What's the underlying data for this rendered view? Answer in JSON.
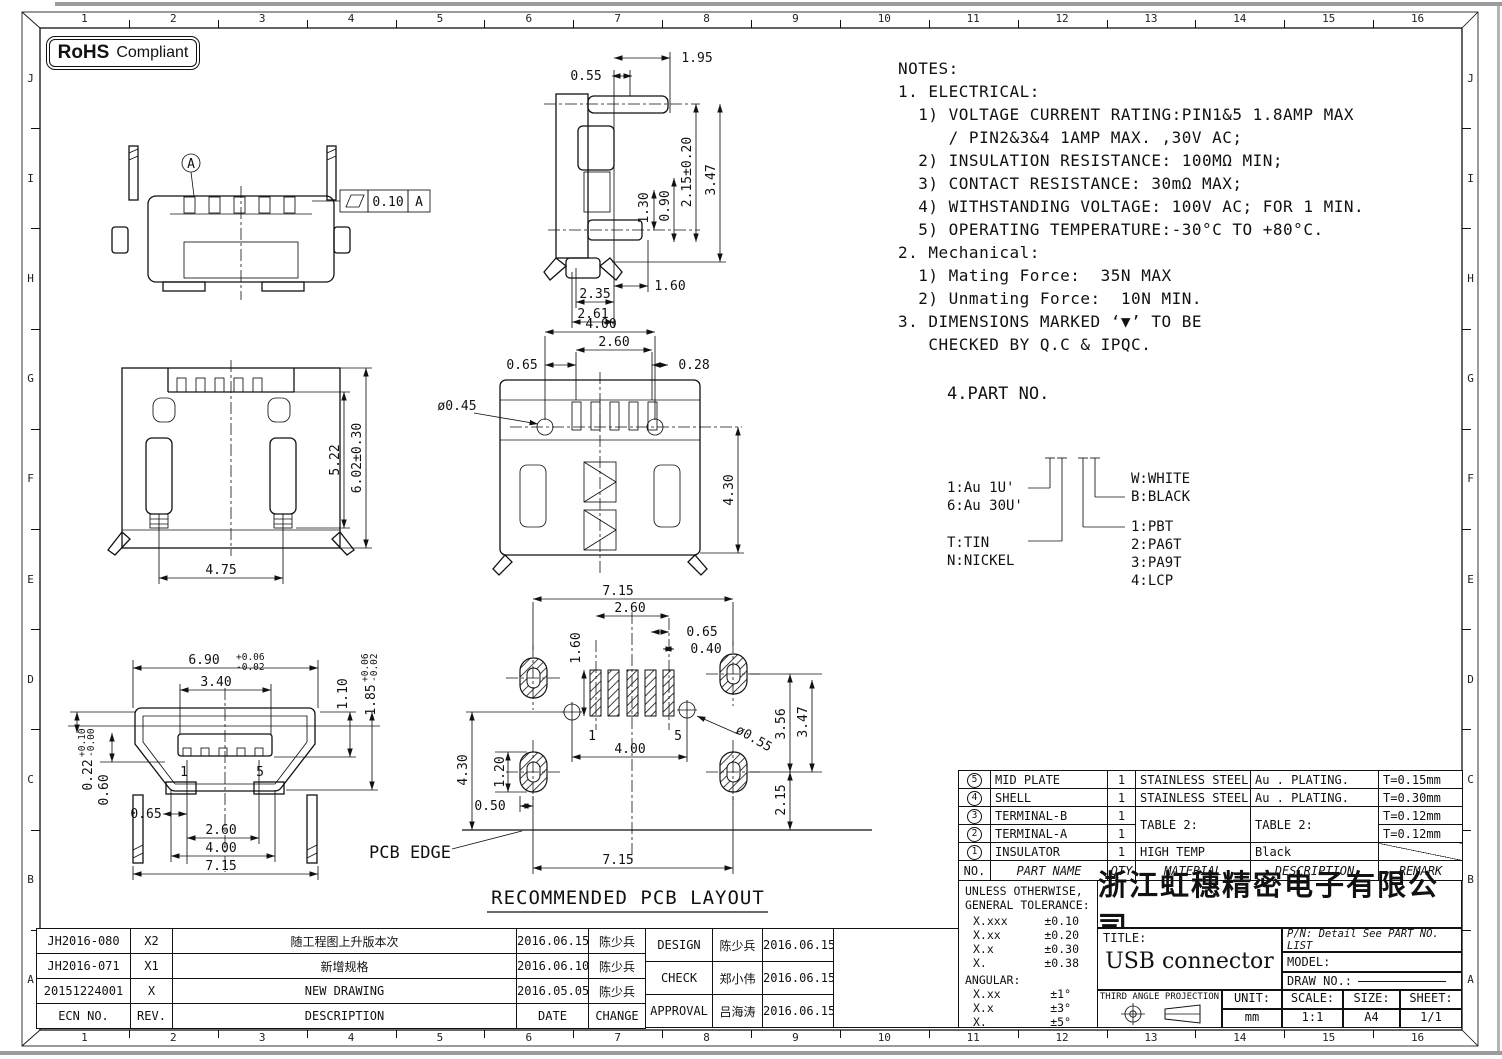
{
  "sheet": {
    "rohs_bold": "RoHS",
    "rohs_rest": "Compliant",
    "border_cols": [
      "1",
      "2",
      "3",
      "4",
      "5",
      "6",
      "7",
      "8",
      "9",
      "10",
      "11",
      "12",
      "13",
      "14",
      "15",
      "16"
    ],
    "border_rows": [
      "J",
      "I",
      "H",
      "G",
      "F",
      "E",
      "D",
      "C",
      "B",
      "A"
    ]
  },
  "notes": {
    "lines": [
      "NOTES:",
      "1. ELECTRICAL:",
      "  1) VOLTAGE CURRENT RATING:PIN1&5 1.8AMP MAX",
      "     / PIN2&3&4 1AMP MAX. ,30V AC;",
      "  2) INSULATION RESISTANCE: 100MΩ MIN;",
      "  3) CONTACT RESISTANCE: 30mΩ MAX;",
      "  4) WITHSTANDING VOLTAGE: 100V AC; FOR 1 MIN.",
      "  5) OPERATING TEMPERATURE:-30°C TO +80°C.",
      "2. Mechanical:",
      "  1) Mating Force:  35N MAX",
      "  2) Unmating Force:  10N MIN.",
      "3. DIMENSIONS MARKED ‘▼’ TO BE",
      "   CHECKED BY Q.C & IPQC."
    ]
  },
  "part_no": {
    "title": "4.PART NO.",
    "plating_1": "1:Au 1U'",
    "plating_6": "6:Au 30U'",
    "term_t": "T:TIN",
    "term_n": "N:NICKEL",
    "color_w": "W:WHITE",
    "color_b": "B:BLACK",
    "mat_1": "1:PBT",
    "mat_2": "2:PA6T",
    "mat_3": "3:PA9T",
    "mat_4": "4:LCP"
  },
  "dims": {
    "rear": {
      "datum": "A",
      "fcf_value": "0.10",
      "fcf_datum": "A"
    },
    "side": {
      "d055": "0.55",
      "d195": "1.95",
      "d130": "1.30",
      "d090": "0.90",
      "d215": "2.15±0.20",
      "d347": "3.47",
      "d160": "1.60",
      "d235": "2.35",
      "d261": "2.61"
    },
    "top": {
      "d522": "5.22",
      "d602": "6.02±0.30",
      "d475": "4.75"
    },
    "bottom": {
      "d400": "4.00",
      "d260": "2.60",
      "d065": "0.65",
      "d028": "0.28",
      "d045": "ø0.45",
      "d430": "4.30"
    },
    "front": {
      "d690": "6.90",
      "d690t": "+0.06",
      "d690b": "-0.02",
      "d340": "3.40",
      "d110": "1.10",
      "d185": "1.85",
      "d185t": "+0.06",
      "d185b": "-0.02",
      "d022": "0.22",
      "d022t": "+0.10",
      "d022b": "-0.00",
      "d060": "0.60",
      "d065": "0.65",
      "d260": "2.60",
      "d400": "4.00",
      "d715": "7.15",
      "pin1": "1",
      "pin5": "5"
    },
    "pcb": {
      "d715t": "7.15",
      "d260": "2.60",
      "d065": "0.65",
      "d040": "0.40",
      "d160": "1.60",
      "d120": "1.20",
      "d430": "4.30",
      "d050": "0.50",
      "d400": "4.00",
      "d055": "ø0.55",
      "d356": "3.56",
      "d347": "3.47",
      "d215": "2.15",
      "d715b": "7.15",
      "edge": "PCB EDGE",
      "pin1": "1",
      "pin5": "5",
      "caption": "RECOMMENDED PCB LAYOUT"
    }
  },
  "parts_table": {
    "header": {
      "no": "NO.",
      "name": "PART NAME",
      "qty": "QTY",
      "material": "MATERIAL",
      "desc": "DESCRIPTION",
      "remark": "REMARK"
    },
    "rows": [
      {
        "no": "5",
        "name": "MID PLATE",
        "qty": "1",
        "material": "STAINLESS STEEL",
        "desc": "Au . PLATING.",
        "remark": "T=0.15mm"
      },
      {
        "no": "4",
        "name": "SHELL",
        "qty": "1",
        "material": "STAINLESS STEEL",
        "desc": "Au . PLATING.",
        "remark": "T=0.30mm"
      },
      {
        "no": "3",
        "name": "TERMINAL-B",
        "qty": "1",
        "material": "TABLE 2:",
        "desc": "TABLE 2:",
        "remark": "T=0.12mm"
      },
      {
        "no": "2",
        "name": "TERMINAL-A",
        "qty": "1",
        "remark": "T=0.12mm"
      },
      {
        "no": "1",
        "name": "INSULATOR",
        "qty": "1",
        "material": "HIGH TEMP",
        "desc": "Black",
        "remark": ""
      }
    ]
  },
  "title_block": {
    "tol_line1": "UNLESS OTHERWISE,",
    "tol_line2": "GENERAL TOLERANCE:",
    "tol_rows": [
      {
        "k": "X.xxx",
        "v": "±0.10"
      },
      {
        "k": "X.xx",
        "v": "±0.20"
      },
      {
        "k": "X.x",
        "v": "±0.30"
      },
      {
        "k": "X.",
        "v": "±0.38"
      }
    ],
    "angular_label": "ANGULAR:",
    "ang_rows": [
      {
        "k": "X.xx",
        "v": "±1°"
      },
      {
        "k": "X.x",
        "v": "±3°"
      },
      {
        "k": "X.",
        "v": "±5°"
      }
    ],
    "company": "浙江虹穗精密电子有限公司",
    "title_label": "TITLE:",
    "title": "USB connector",
    "pn": "P/N: Detail See PART NO. LIST",
    "model_label": "MODEL:",
    "draw_label": "DRAW NO.:",
    "projection": "THIRD ANGLE PROJECTION",
    "unit_label": "UNIT:",
    "unit": "mm",
    "scale_label": "SCALE:",
    "scale": "1:1",
    "size_label": "SIZE:",
    "size": "A4",
    "sheet_label": "SHEET:",
    "sheet": "1/1"
  },
  "revision_table": {
    "header": {
      "ecn": "ECN NO.",
      "rev": "REV.",
      "desc": "DESCRIPTION",
      "date": "DATE",
      "change": "CHANGE"
    },
    "rows": [
      {
        "ecn": "JH2016-080",
        "rev": "X2",
        "desc": "随工程图上升版本次",
        "date": "2016.06.15",
        "change": "陈少兵"
      },
      {
        "ecn": "JH2016-071",
        "rev": "X1",
        "desc": "新增规格",
        "date": "2016.06.10",
        "change": "陈少兵"
      },
      {
        "ecn": "20151224001",
        "rev": "X",
        "desc": "NEW DRAWING",
        "date": "2016.05.05",
        "change": "陈少兵"
      }
    ]
  },
  "approval_table": {
    "rows": [
      {
        "role": "DESIGN",
        "name": "陈少兵",
        "date": "2016.06.15"
      },
      {
        "role": "CHECK",
        "name": "郑小伟",
        "date": "2016.06.15"
      },
      {
        "role": "APPROVAL",
        "name": "吕海涛",
        "date": "2016.06.15"
      }
    ]
  }
}
